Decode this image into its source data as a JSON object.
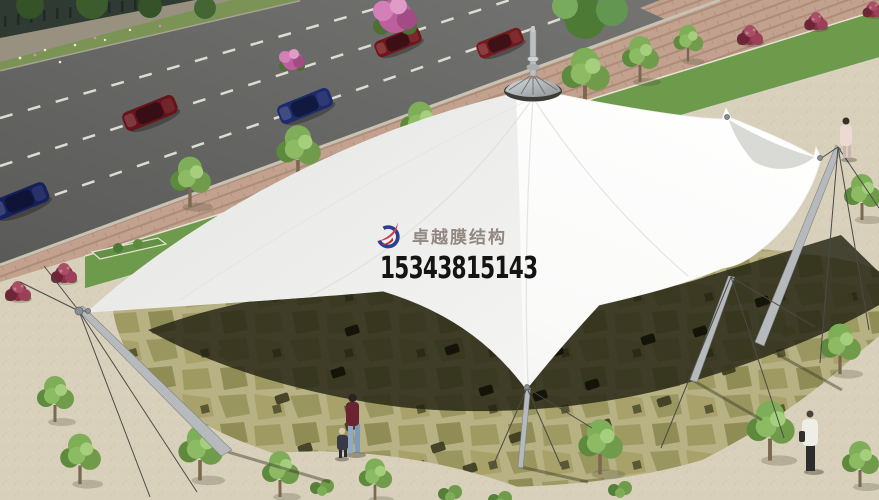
{
  "watermark": {
    "brand": "卓越膜结构",
    "phone": "15343815143",
    "brand_color": "#8a8078",
    "phone_color": "#141414",
    "logo": {
      "blue": "#2b3f93",
      "red": "#d23c46"
    }
  },
  "scene": {
    "subject": "aerial rendering of white tensile membrane canopy beside a road",
    "colors": {
      "plaza": "#d8d0ba",
      "road": "#6c6c6a",
      "laneDash": "#dddcd4",
      "curb": "#b3ac9c",
      "brick": "#c2a28e",
      "grass": "#7b9355",
      "wall": "#98917f",
      "fence": "#2f3a33",
      "greenStrip": "#6d9a4b",
      "stripCurb": "#e7e3d4",
      "flagGrout": "#b7b183",
      "stoneA": "#9a9660",
      "stoneB": "#a8a26a",
      "stoneC": "#908c56",
      "stoneD": "#9e9a62",
      "stoneDark": "#5a5736",
      "shadow": "#202012",
      "canopy": "#fbfbfa",
      "canopyShade": "#e7e7e5",
      "sailShade": "#d9d9d5",
      "peakRing": "#3c3c38",
      "metal": "#b6babc",
      "cable": "#4a4a48",
      "bushMaroon": "#8a3248",
      "flowerPink": "#bd5f9d",
      "treeGreen": "#6f9b4a"
    },
    "road": {
      "lane_dash_lines": 3
    },
    "cars": [
      {
        "body": "#6e1619",
        "x": 398,
        "y": 42
      },
      {
        "body": "#741a1d",
        "x": 500,
        "y": 43
      },
      {
        "body": "#66141a",
        "x": 150,
        "y": 113
      },
      {
        "body": "#1d2a6b",
        "x": 305,
        "y": 106
      },
      {
        "body": "#16205c",
        "x": 20,
        "y": 201
      }
    ],
    "people": [
      {
        "label": "woman-with-child",
        "x": 352,
        "y": 430
      },
      {
        "label": "child",
        "x": 341,
        "y": 445
      },
      {
        "label": "pedestrian-pink-dress",
        "x": 846,
        "y": 140
      },
      {
        "label": "pedestrian-white-jacket",
        "x": 810,
        "y": 445
      }
    ],
    "masts_count": 4,
    "trees_count": 16
  }
}
